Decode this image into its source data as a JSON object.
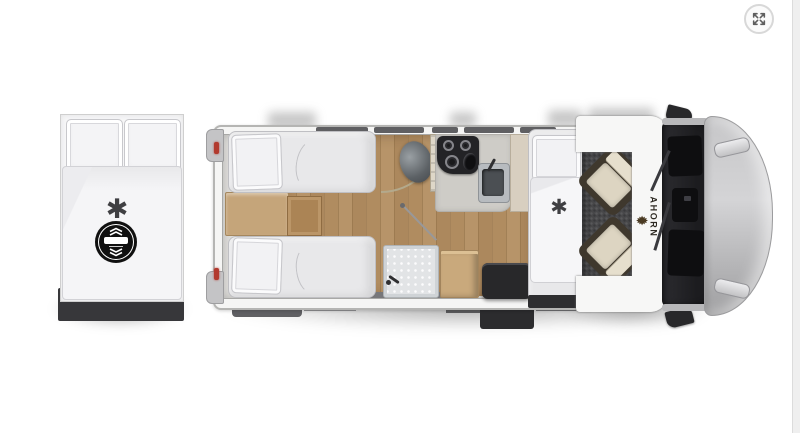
{
  "viewer": {
    "expand_icon": "expand-arrows-icon"
  },
  "branding": {
    "logo_text": "AHORN",
    "logo_icon": "maple-leaf-icon"
  },
  "symbols": {
    "bedding_asterisk": "✱",
    "bed_logo_icon": "adjustable-bed-icon",
    "bed_logo_chevron_up": "chevron-up-icon",
    "bed_logo_chevron_down": "chevron-down-icon"
  },
  "colors": {
    "wood-floor": "#ad8a5e",
    "body-white": "#f5f5f4",
    "tail-light": "#b23a2e",
    "cab-floor": "#48484a",
    "seat-cushion": "#ddd5c2",
    "windshield": "#1f1f23",
    "hood": "#bfbfc1",
    "brand-text": "#2e2a23",
    "logo-black": "#101010"
  }
}
